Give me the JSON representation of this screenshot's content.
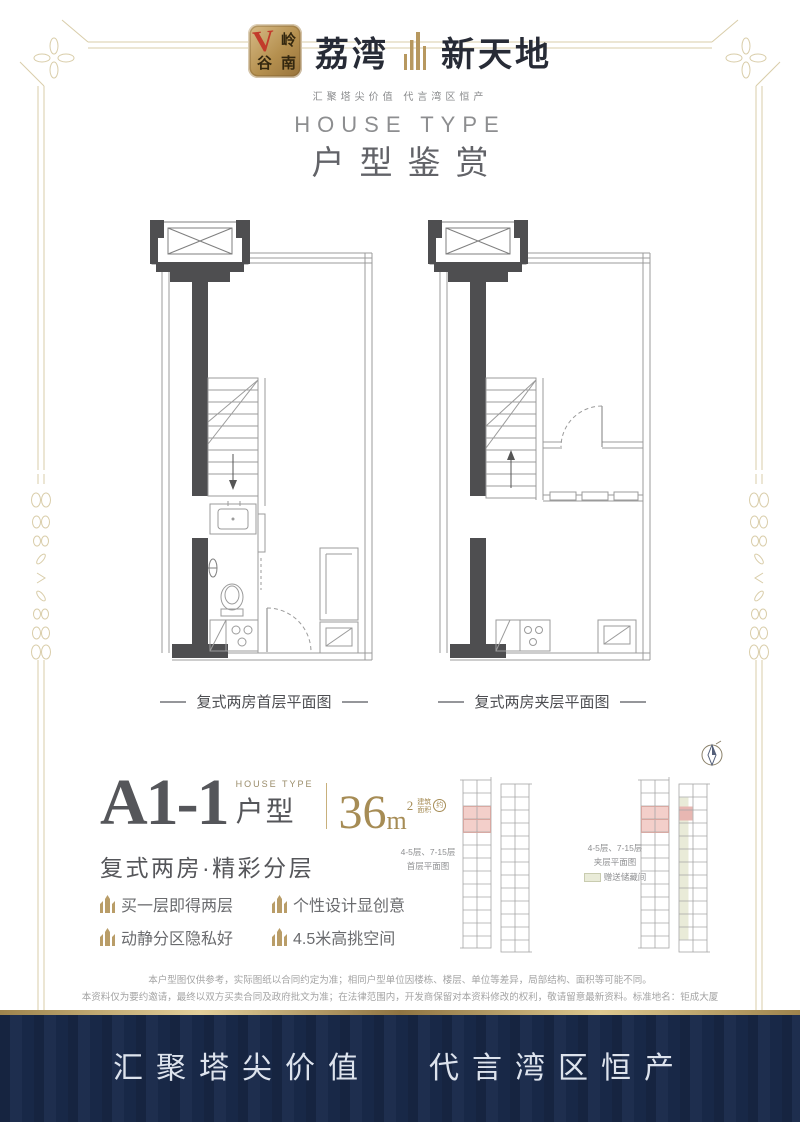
{
  "brand": {
    "logo": {
      "check": "V",
      "char_top": "岭",
      "char_bottom_left": "谷",
      "char_bottom_right": "南"
    },
    "name_left": "荔湾",
    "name_right": "新天地",
    "tagline": "汇聚塔尖价值  代言湾区恒产"
  },
  "header": {
    "title_en": "HOUSE TYPE",
    "title_cn": "户型鉴赏"
  },
  "plans": {
    "first_floor_caption": "复式两房首层平面图",
    "mezzanine_caption": "复式两房夹层平面图"
  },
  "unit": {
    "code": "A1-1",
    "house_type_en": "HOUSE TYPE",
    "house_type_cn": "户型",
    "area_value": "36",
    "area_unit": "m",
    "area_exponent": "2",
    "area_prefix_1": "建筑",
    "area_prefix_2": "面积",
    "area_approx": "约",
    "subtitle": "复式两房·精彩分层",
    "features": [
      "买一层即得两层",
      "个性设计显创意",
      "动静分区隐私好",
      "4.5米高挑空间"
    ]
  },
  "keyplans": {
    "left": {
      "line1": "4-5层、7-15层",
      "line2": "首层平面图"
    },
    "right": {
      "line1": "4-5层、7-15层",
      "line2": "夹层平面图"
    },
    "legend_label": "赠送储藏间"
  },
  "disclaimer": {
    "line1": "本户型图仅供参考，实际图纸以合同约定为准；相同户型单位因楼栋、楼层、单位等差异，局部结构、面积等可能不同。",
    "line2": "本资料仅为要约邀请，最终以双方买卖合同及政府批文为准；在法律范围内，开发商保留对本资料修改的权利，敬请留意最新资料。标准地名：钜成大厦"
  },
  "footer": {
    "slogan_left": "汇聚塔尖价值",
    "slogan_right": "代言湾区恒产"
  },
  "colors": {
    "gold": "#b29a6b",
    "frame_gold": "#d9cda9",
    "navy": "#1a2a4b",
    "highlight_pink": "#f3cfca",
    "logo_red": "#c23b2b",
    "wall_dark": "#4e4e50"
  }
}
